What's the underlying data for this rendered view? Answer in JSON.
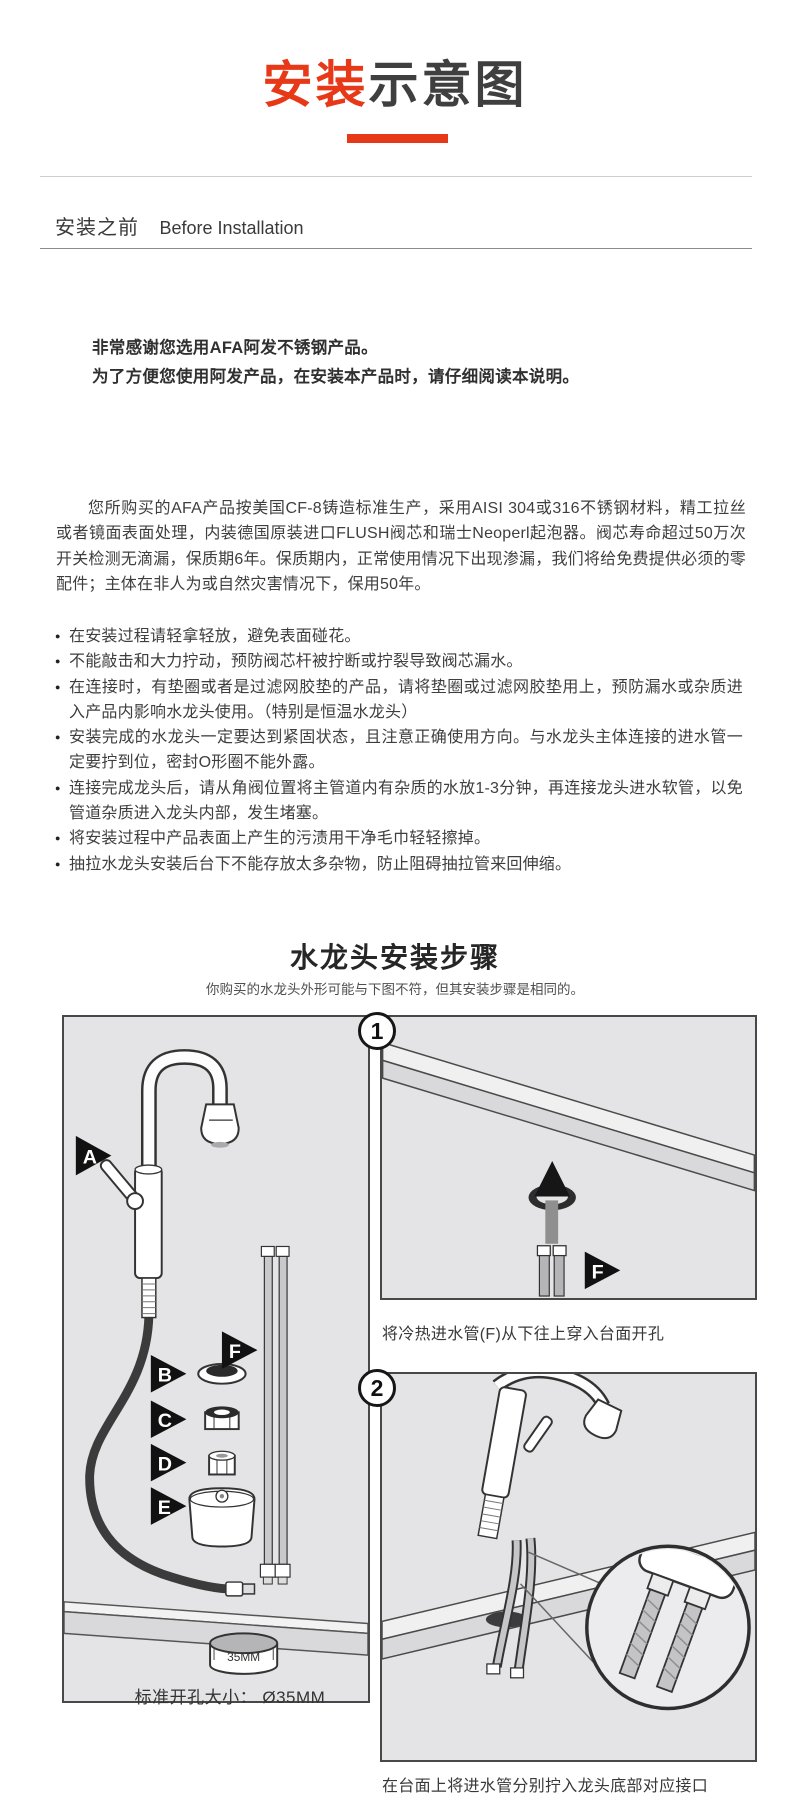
{
  "page_title": {
    "highlight": "安装",
    "rest": "示意图"
  },
  "colors": {
    "accent_red": "#e73918",
    "panel_background": "#e4e4e6",
    "panel_border": "#484848",
    "body_text": "#3e3e3e"
  },
  "before_installation": {
    "heading_zh": "安装之前",
    "heading_en": "Before Installation",
    "thanks_line1": "非常感谢您选用AFA阿发不锈钢产品。",
    "thanks_line2": "为了方便您使用阿发产品，在安装本产品时，请仔细阅读本说明。",
    "intro_paragraph": "您所购买的AFA产品按美国CF-8铸造标准生产，采用AISI 304或316不锈钢材料，精工拉丝或者镜面表面处理，内装德国原装进口FLUSH阀芯和瑞士Neoperl起泡器。阀芯寿命超过50万次开关检测无滴漏，保质期6年。保质期内，正常使用情况下出现渗漏，我们将给免费提供必须的零配件；主体在非人为或自然灾害情况下，保用50年。",
    "notes": [
      "在安装过程请轻拿轻放，避免表面碰花。",
      "不能敲击和大力拧动，预防阀芯杆被拧断或拧裂导致阀芯漏水。",
      "在连接时，有垫圈或者是过滤网胶垫的产品，请将垫圈或过滤网胶垫用上，预防漏水或杂质进入产品内影响水龙头使用。（特别是恒温水龙头）",
      "安装完成的水龙头一定要达到紧固状态，且注意正确使用方向。与水龙头主体连接的进水管一定要拧到位，密封O形圈不能外露。",
      "连接完成龙头后，请从角阀位置将主管道内有杂质的水放1-3分钟，再连接龙头进水软管，以免管道杂质进入龙头内部，发生堵塞。",
      "将安装过程中产品表面上产生的污渍用干净毛巾轻轻擦掉。",
      "抽拉水龙头安装后台下不能存放太多杂物，防止阻碍抽拉管来回伸缩。"
    ]
  },
  "installation_steps": {
    "heading": "水龙头安装步骤",
    "subheading": "你购买的水龙头外形可能与下图不符，但其安装步骤是相同的。",
    "parts_panel": {
      "label_a": "A",
      "label_b": "B",
      "label_c": "C",
      "label_d": "D",
      "label_e": "E",
      "label_f": "F",
      "ring_text": "35MM",
      "hole_size_caption": "标准开孔大小： Ø35MM"
    },
    "steps": [
      {
        "number": "1",
        "caption": "将冷热进水管(F)从下往上穿入台面开孔"
      },
      {
        "number": "2",
        "caption": "在台面上将进水管分别拧入龙头底部对应接口"
      }
    ]
  }
}
